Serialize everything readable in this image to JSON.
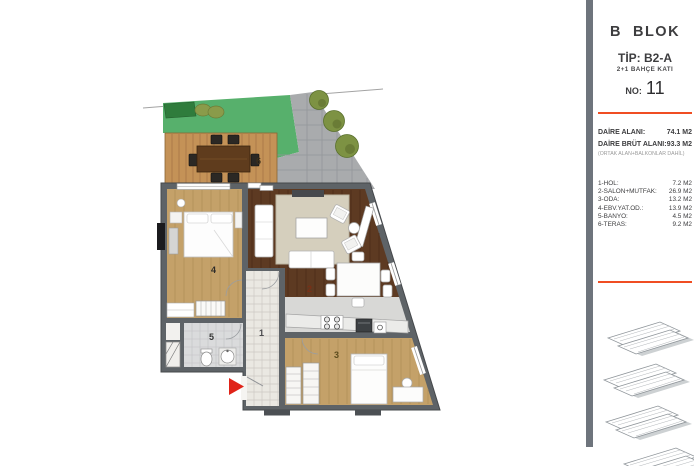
{
  "panel": {
    "bar_color": "#6e747c",
    "accent_color": "#f04e23",
    "block_title": "B  BLOK",
    "tip": "TİP: B2-A",
    "floor_type": "2+1 BAHÇE KATI",
    "no_label": "NO:",
    "no_value": "11",
    "area_rows": [
      {
        "label": "DAİRE ALANI:",
        "value": "74.1 M2"
      },
      {
        "label": "DAİRE BRÜT ALANI:",
        "value": "93.3 M2"
      }
    ],
    "area_note": "(ORTAK ALAN+BALKONLAR DAHİL)",
    "room_rows": [
      {
        "label": "1-HOL:",
        "value": "7.2 M2"
      },
      {
        "label": "2-SALON+MUTFAK:",
        "value": "26.9 M2"
      },
      {
        "label": "3-ODA:",
        "value": "13.2 M2"
      },
      {
        "label": "4-EBV.YAT.OD.:",
        "value": "13.9 M2"
      },
      {
        "label": "5-BANYO:",
        "value": "4.5 M2"
      },
      {
        "label": "6-TERAS:",
        "value": "9.2 M2"
      }
    ]
  },
  "plan": {
    "room_numbers": {
      "hol": "1",
      "salon": "2",
      "oda": "3",
      "ebeveyn": "4",
      "banyo": "5",
      "teras": "6"
    },
    "colors": {
      "grass": "#57b06c",
      "hedge": "#2f7c3c",
      "pavement": "#a9abad",
      "deck_wood": "#c49257",
      "light_wood": "#c4a169",
      "dark_wood": "#5d3a22",
      "wall": "#5e6367",
      "hall_tile": "#eae8e2",
      "bath_tile": "#dadbdc",
      "entrance_arrow": "#e02318"
    }
  }
}
